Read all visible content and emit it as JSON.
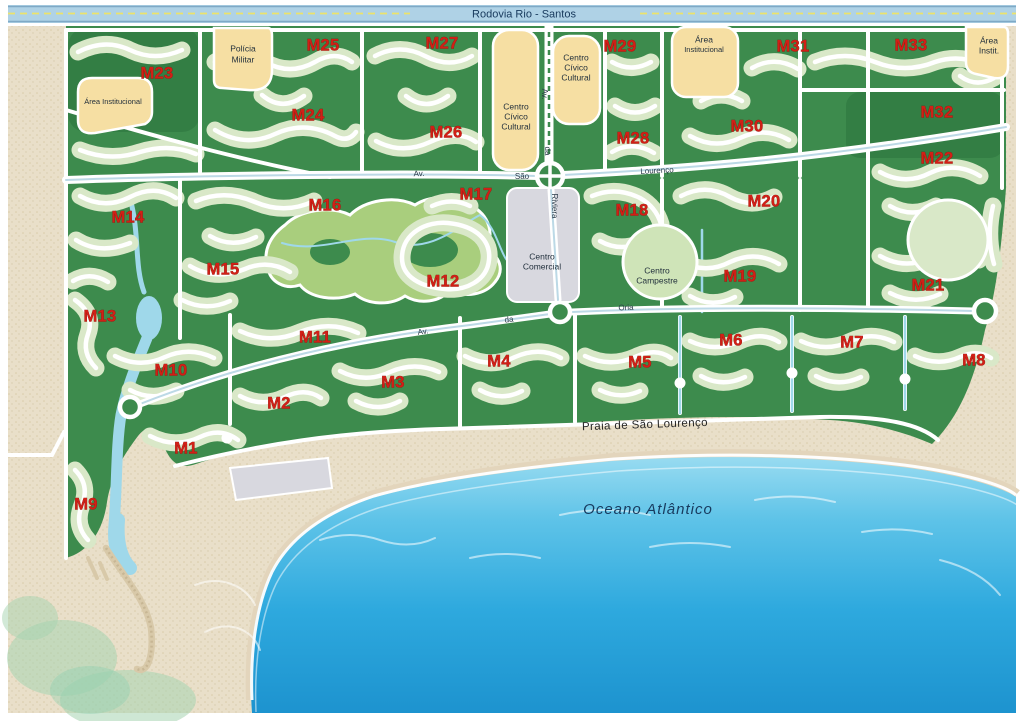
{
  "highway": {
    "label": "Rodovia Rio - Santos"
  },
  "modules": [
    {
      "label": "M1"
    },
    {
      "label": "M2"
    },
    {
      "label": "M3"
    },
    {
      "label": "M4"
    },
    {
      "label": "M5"
    },
    {
      "label": "M6"
    },
    {
      "label": "M7"
    },
    {
      "label": "M8"
    },
    {
      "label": "M9"
    },
    {
      "label": "M10"
    },
    {
      "label": "M11"
    },
    {
      "label": "M12"
    },
    {
      "label": "M13"
    },
    {
      "label": "M14"
    },
    {
      "label": "M15"
    },
    {
      "label": "M16"
    },
    {
      "label": "M17"
    },
    {
      "label": "M18"
    },
    {
      "label": "M19"
    },
    {
      "label": "M20"
    },
    {
      "label": "M21"
    },
    {
      "label": "M22"
    },
    {
      "label": "M23"
    },
    {
      "label": "M24"
    },
    {
      "label": "M25"
    },
    {
      "label": "M26"
    },
    {
      "label": "M27"
    },
    {
      "label": "M28"
    },
    {
      "label": "M29"
    },
    {
      "label": "M30"
    },
    {
      "label": "M31"
    },
    {
      "label": "M32"
    },
    {
      "label": "M33"
    }
  ],
  "places": {
    "area_institucional_left": "Área Institucional",
    "policia_l1": "Polícia",
    "policia_l2": "Militar",
    "ccc_l1": "Centro",
    "ccc_l2": "Cívico",
    "ccc_l3": "Cultural",
    "area_inst_tr_l1": "Área",
    "area_inst_tr_l2": "Institucional",
    "area_instit_fr_l1": "Área",
    "area_instit_fr_l2": "Instit.",
    "centro_comercial_l1": "Centro",
    "centro_comercial_l2": "Comercial",
    "centro_campestre_l1": "Centro",
    "centro_campestre_l2": "Campestre"
  },
  "streets": {
    "av": "Av.",
    "da": "da",
    "sao": "São",
    "lourenco": "Lourenço",
    "riviera": "Riviera",
    "oria": "Oria"
  },
  "coast": {
    "praia": "Praia de São Lourenço",
    "oceano": "Oceano Atlântico"
  },
  "colors": {
    "land_green": "#3d8b4d",
    "lots_green": "#d9e8c8",
    "sand": "#e9dfc9",
    "institutional_tan": "#f6dfa3",
    "commercial_grey": "#d8d8df",
    "highway_blue": "#afd2e6",
    "golf_green": "#a9ce7d",
    "water_blue": "#9fd8ea",
    "ocean_blue": "#2ea9de",
    "module_label_red": "#d21f16"
  }
}
